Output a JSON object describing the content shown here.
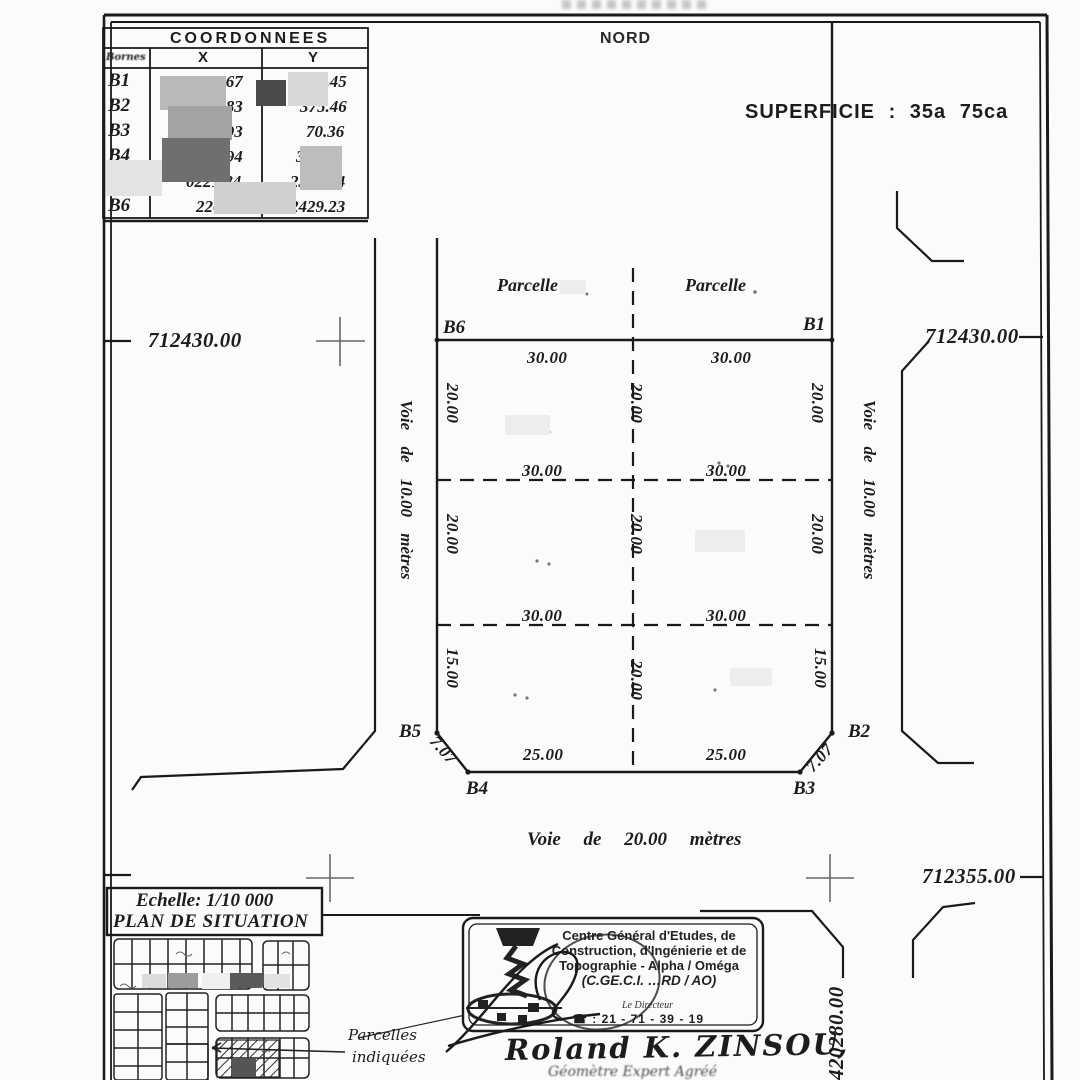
{
  "header": {
    "north": "NORD",
    "superficie": "SUPERFICIE : 35a 75ca"
  },
  "table": {
    "title": "COORDONNEES",
    "bornes_header": "Bornes",
    "x_header": "X",
    "y_header": "Y",
    "rows": [
      {
        "id": "B1",
        "x": "280.67",
        "y": "430.45"
      },
      {
        "id": "B2",
        "x": "281.83",
        "y": "375.46"
      },
      {
        "id": "B3",
        "x": "276.93",
        "y": "70.36"
      },
      {
        "id": "B4",
        "x": "226.94",
        "y": "369.34"
      },
      {
        "id": "B5",
        "x": "0221.84",
        "y": "2374.24"
      },
      {
        "id": "B6",
        "x": "220.68",
        "y": "2429.23"
      }
    ]
  },
  "plan": {
    "parcel_label_left": "Parcelle",
    "parcel_label_right": "Parcelle",
    "corners": {
      "b1": "B1",
      "b2": "B2",
      "b3": "B3",
      "b4": "B4",
      "b5": "B5",
      "b6": "B6"
    },
    "dims": {
      "top": [
        "30.00",
        "30.00"
      ],
      "row1": [
        "30.00",
        "30.00"
      ],
      "row2": [
        "30.00",
        "30.00"
      ],
      "bottom": [
        "25.00",
        "25.00"
      ],
      "left": [
        "20.00",
        "20.00",
        "15.00"
      ],
      "center": [
        "20.00",
        "20.00",
        "20.00"
      ],
      "right": [
        "20.00",
        "20.00",
        "15.00"
      ],
      "chamfer_left": "7.07",
      "chamfer_right": "7.07"
    },
    "roads": {
      "left": "Voie de 10.00 mètres",
      "right": "Voie de 10.00 mètres",
      "bottom": "Voie de 20.00 mètres"
    },
    "grid": {
      "left_712430": "712430.00",
      "right_712430": "712430.00",
      "right_712355": "712355.00",
      "vert_420280": "420280.00"
    }
  },
  "situation": {
    "scale": "Echelle: 1/10 000",
    "title": "PLAN DE SITUATION",
    "callout_line1": "Parcelles",
    "callout_line2": "indiquées"
  },
  "stamp": {
    "line1": "Centre Général d'Etudes, de",
    "line2": "Construction, d'Ingénierie et de",
    "line3": "Topographie - Alpha / Oméga",
    "line4": "(C.GE.C.I. …RD / AO)",
    "director": "Le Directeur",
    "phone": "☎ : 21 - 71 - 39 - 19"
  },
  "signature": {
    "name": "Roland K. ZINSOU,",
    "title": "Géomètre Expert Agréé"
  },
  "colors": {
    "ink": "#1c1c1c",
    "paper": "#fcfbf9"
  }
}
